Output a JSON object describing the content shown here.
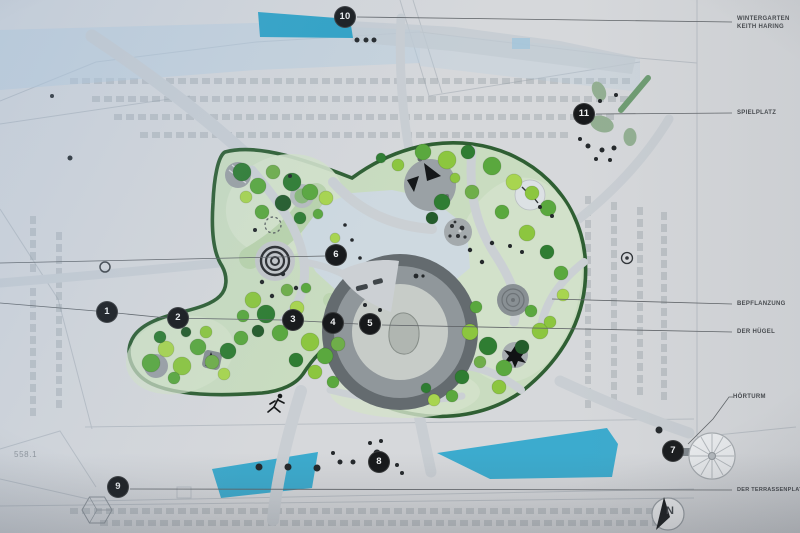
{
  "plan": {
    "annotations": {
      "wintergarten_line1": "WINTERGARTEN",
      "wintergarten_line2": "KEITH HARING",
      "spielplatz": "SPIELPLATZ",
      "bepflanzung": "BEPFLANZUNG",
      "der_huegel": "DER HÜGEL",
      "hoerturm": "HÖRTURM",
      "terrassenplatz": "DER TERRASSENPLATZ"
    },
    "markers": [
      "1",
      "2",
      "3",
      "4",
      "5",
      "6",
      "7",
      "8",
      "9",
      "10",
      "11"
    ],
    "survey_label": "558.1",
    "compass_letter": "N",
    "colors": {
      "water": "#3aa5c8",
      "park_fill": "#c9dcc0",
      "park_outline": "#2f5f33",
      "pond": "#ced9e0",
      "marker_bg": "#17191b",
      "label_text": "#43464a",
      "background": "#d6d8db"
    }
  }
}
